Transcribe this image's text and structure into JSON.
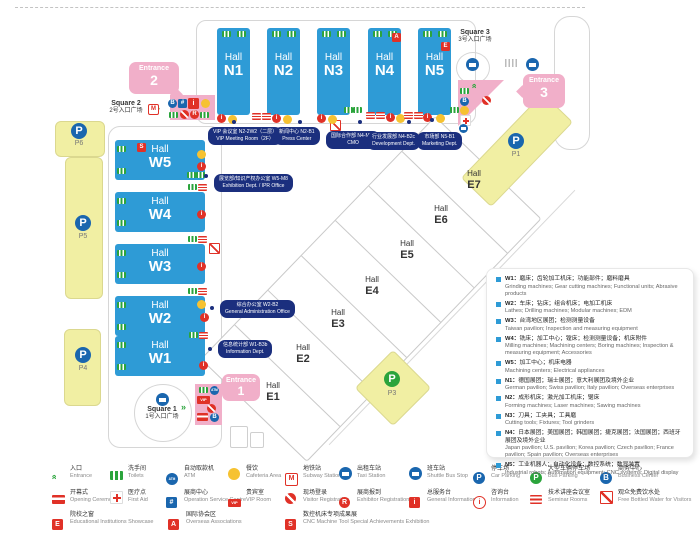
{
  "icons": {
    "p": "P",
    "b": "B",
    "r": "R",
    "s": "S",
    "e": "E",
    "a": "A",
    "i": "i",
    "atm": "ATM",
    "vip": "VIP",
    "op": "#",
    "m": "M",
    "arrows": "»"
  },
  "map": {
    "n_halls": [
      {
        "hall": "Hall",
        "code": "N1"
      },
      {
        "hall": "Hall",
        "code": "N2"
      },
      {
        "hall": "Hall",
        "code": "N3"
      },
      {
        "hall": "Hall",
        "code": "N4"
      },
      {
        "hall": "Hall",
        "code": "N5"
      }
    ],
    "w_halls": [
      {
        "hall": "Hall",
        "code": "W5"
      },
      {
        "hall": "Hall",
        "code": "W4"
      },
      {
        "hall": "Hall",
        "code": "W3"
      },
      {
        "hall": "Hall",
        "code": "W2"
      },
      {
        "hall": "Hall",
        "code": "W1"
      }
    ],
    "e_halls": [
      {
        "hall": "Hall",
        "code": "E1"
      },
      {
        "hall": "Hall",
        "code": "E2"
      },
      {
        "hall": "Hall",
        "code": "E3"
      },
      {
        "hall": "Hall",
        "code": "E4"
      },
      {
        "hall": "Hall",
        "code": "E5"
      },
      {
        "hall": "Hall",
        "code": "E6"
      },
      {
        "hall": "Hall",
        "code": "E7"
      }
    ],
    "parking": {
      "p1": "P1",
      "p3": "P3",
      "p4": "P4",
      "p5": "P5",
      "p6": "P6"
    },
    "entrances": {
      "e1": {
        "word": "Entrance",
        "num": "1"
      },
      "e2": {
        "word": "Entrance",
        "num": "2"
      },
      "e3": {
        "word": "Entrance",
        "num": "3"
      }
    },
    "squares": {
      "s1": {
        "en": "Square 1",
        "zh": "1号入口广场"
      },
      "s2": {
        "en": "Square 2",
        "zh": "2号入口广场"
      },
      "s3": {
        "en": "Square 3",
        "zh": "3号入口广场"
      }
    },
    "callouts": {
      "vip": {
        "zh": "VIP 会议室 N2-2W2（二层）",
        "en": "VIP Meeting Room（2F）"
      },
      "press": {
        "zh": "新闻中心 N2-B1",
        "en": "Press Center"
      },
      "cmo": {
        "zh": "国际合作部 N4-M44",
        "en": "CMO"
      },
      "dev": {
        "zh": "行业发展部 N4-B2c",
        "en": "Development Dept."
      },
      "mkt": {
        "zh": "市场部 N5-B1",
        "en": "Marketing Dept."
      },
      "w5": {
        "zh": "展览部/知识产权办公室 W5-M8",
        "en": "Exhibition Dept. / IPR Office"
      },
      "w2": {
        "zh": "综合办公室 W2-B2",
        "en": "General Administration Office"
      },
      "w1": {
        "zh": "信息统计部 W1-B3b",
        "en": "Information Dept."
      }
    }
  },
  "hall_legend": [
    {
      "code": "W1：",
      "zh": "磨床；齿轮加工机床；功能部件；磨料磨具",
      "en": "Grinding machines; Gear cutting machines; Functional units; Abrasive products"
    },
    {
      "code": "W2：",
      "zh": "车床；钻床；组合机床；电加工机床",
      "en": "Lathes; Drilling machines; Modular machines; EDM"
    },
    {
      "code": "W3：",
      "zh": "台湾地区展团；检测测量设备",
      "en": "Taiwan pavilion; Inspection and measuring equipment"
    },
    {
      "code": "W4：",
      "zh": "铣床；加工中心；镗床；检测测量设备；机床附件",
      "en": "Milling machines; Machining centers; Boring machines; Inspection & measuring equipment; Accessories"
    },
    {
      "code": "W5：",
      "zh": "加工中心；机床电器",
      "en": "Machining centers; Electrical appliances"
    },
    {
      "code": "N1：",
      "zh": "德国展团；瑞士展团；意大利展团及境外企业",
      "en": "German pavilion; Swiss pavilion; Italy pavilion; Overseas enterprises"
    },
    {
      "code": "N2：",
      "zh": "成形机床；激光加工机床；锯床",
      "en": "Forming machines; Laser machines; Sawing machines"
    },
    {
      "code": "N3：",
      "zh": "刀具；工夹具；工具磨",
      "en": "Cutting tools; Fixtures; Tool grinders"
    },
    {
      "code": "N4：",
      "zh": "日本展团；美国展团；韩国展团；捷克展团；法国展团；西班牙展团及境外企业",
      "en": "Japan pavilion; U.S. pavilion; Korea pavilion; Czech pavilion; France pavilion; Spain pavilion; Overseas enterprises"
    },
    {
      "code": "N5：",
      "zh": "工业机器人；自动化设备；数控系统；数显装置",
      "en": "Industrial robots; Automation equipment; CNC systems; Digital display"
    }
  ],
  "facility_legend": {
    "row1": [
      {
        "zh": "入口",
        "en": "Entrance"
      },
      {
        "zh": "洗手间",
        "en": "Toilets"
      },
      {
        "zh": "自动取款机",
        "en": "ATM"
      },
      {
        "zh": "餐饮",
        "en": "Cafeteria Area"
      },
      {
        "zh": "地铁站",
        "en": "Subway Station"
      },
      {
        "zh": "出租车站",
        "en": "Taxi Station"
      },
      {
        "zh": "班车站",
        "en": "Shuttle Bus Stop"
      },
      {
        "zh": "停车场",
        "en": "Car Parking"
      },
      {
        "zh": "大型车辆停车场",
        "en": "Bus Parking"
      },
      {
        "zh": "商务中心",
        "en": "Business Center"
      }
    ],
    "row2": [
      {
        "zh": "开幕式",
        "en": "Opening Ceremony"
      },
      {
        "zh": "医疗点",
        "en": "First Aid"
      },
      {
        "zh": "展商中心",
        "en": "Operation Service Centre"
      },
      {
        "zh": "贵宾室",
        "en": "VIP Room"
      },
      {
        "zh": "现场登录",
        "en": "Visitor Registration"
      },
      {
        "zh": "展商报到",
        "en": "Exhibitor Registration"
      },
      {
        "zh": "总服务台",
        "en": "General Information"
      },
      {
        "zh": "咨询台",
        "en": "Information"
      },
      {
        "zh": "技术讲座会议室",
        "en": "Seminar Rooms"
      },
      {
        "zh": "观众免费饮水处",
        "en": "Free Bottled Water for Visitors"
      }
    ],
    "row3": [
      {
        "zh": "院校之窗",
        "en": "Educational Institutions Showcase"
      },
      {
        "zh": "国际协会区",
        "en": "Overseas Associations"
      },
      {
        "zh": "数控机床专项成果展",
        "en": "CNC Machine Tool Special Achievements Exhibition"
      }
    ]
  },
  "colors": {
    "hall_blue": "#2E9BD6",
    "parking_yellow": "#F1EFA3",
    "entrance_pink": "#F1AFC9",
    "callout_navy": "#1B2F7E",
    "red": "#E03127",
    "green": "#2BA43C",
    "yellow": "#F6C231",
    "blue": "#1A66AE"
  }
}
